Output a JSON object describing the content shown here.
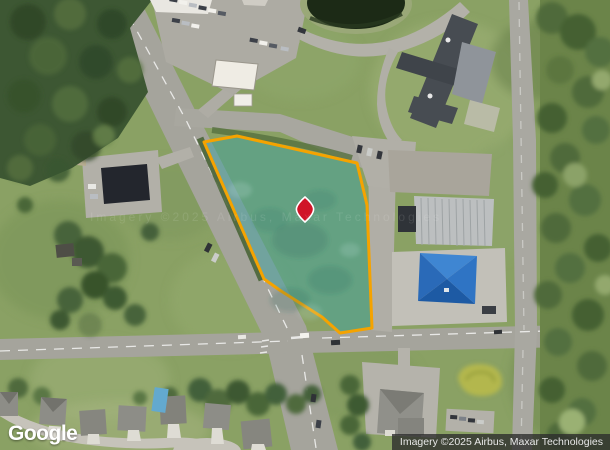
{
  "map": {
    "view_type": "satellite",
    "logo_text": "Google",
    "attribution_text": "Imagery ©2025 Airbus, Maxar Technologies",
    "watermark_text": "Imagery ©2025 Airbus, Maxar Technologies",
    "parcel": {
      "outline_color": "#F5A300",
      "fill_color": "#3DA2A0",
      "fill_opacity": "0.5",
      "path": "M 204,142 L 237,136 L 357,163 L 367,205 L 372,328 L 340,333 L 322,317 L 281,291 L 264,279 Z"
    },
    "marker": {
      "color": "#D01428",
      "outline_color": "#FFFFFF",
      "path": "M305,197 Q312.5,203.5 313.5,208 Q314.5,213.5 305,222 Q295.5,213.5 296.5,208 Q297.5,203.5 305,197 Z"
    }
  }
}
